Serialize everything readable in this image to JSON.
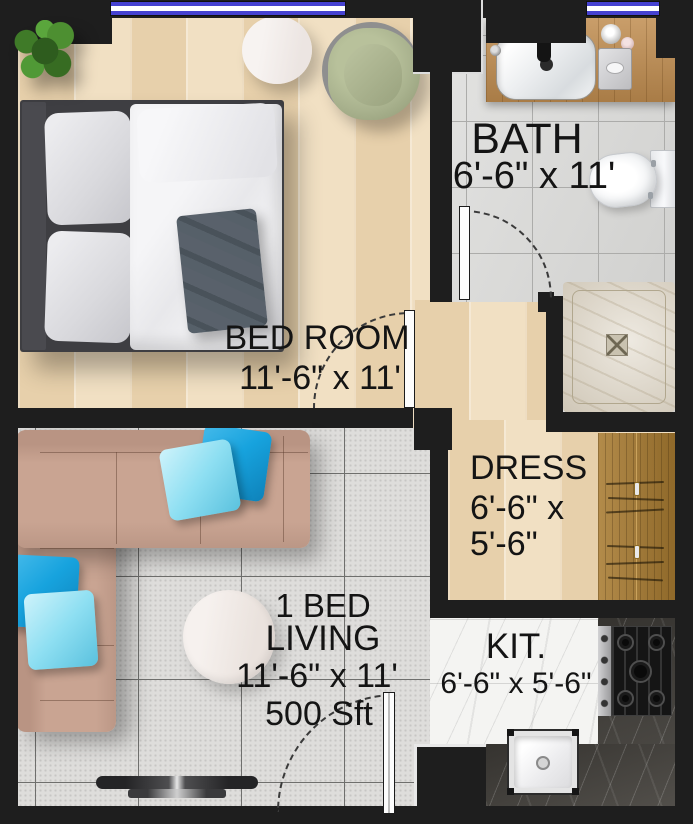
{
  "title": "1 BED apartment floor plan",
  "rooms": {
    "bedroom": {
      "name": "BED ROOM",
      "dims": "11'-6\" x 11'"
    },
    "bath": {
      "name": "BATH",
      "dims": "6'-6\" x 11'"
    },
    "dress": {
      "name": "DRESS",
      "dims_line1": "6'-6\" x",
      "dims_line2": "5'-6\""
    },
    "living": {
      "unit_type": "1 BED",
      "name": "LIVING",
      "dims": "11'-6\" x 11'",
      "area": "500 Sft"
    },
    "kitchen": {
      "name": "KIT.",
      "dims": "6'-6\" x 5'-6\""
    }
  },
  "colors": {
    "wall": "#1e1e1e",
    "window_blue": "#4642d1",
    "wood": "#ecd9ba",
    "bath_tile": "#d9d9d7",
    "living_tile": "#dedddb",
    "marble_white": "#f4f4f2",
    "marble_dark": "#47443f",
    "sofa": "#c9a492",
    "pillow_blue": "#17a3de",
    "pillow_light": "#8edff2",
    "wardrobe": "#a87b31",
    "vanity_wood": "#c08d50",
    "shower_tray": "#dcd3c2",
    "chair_green": "#a9b28e",
    "blanket_gray": "#59616b"
  }
}
